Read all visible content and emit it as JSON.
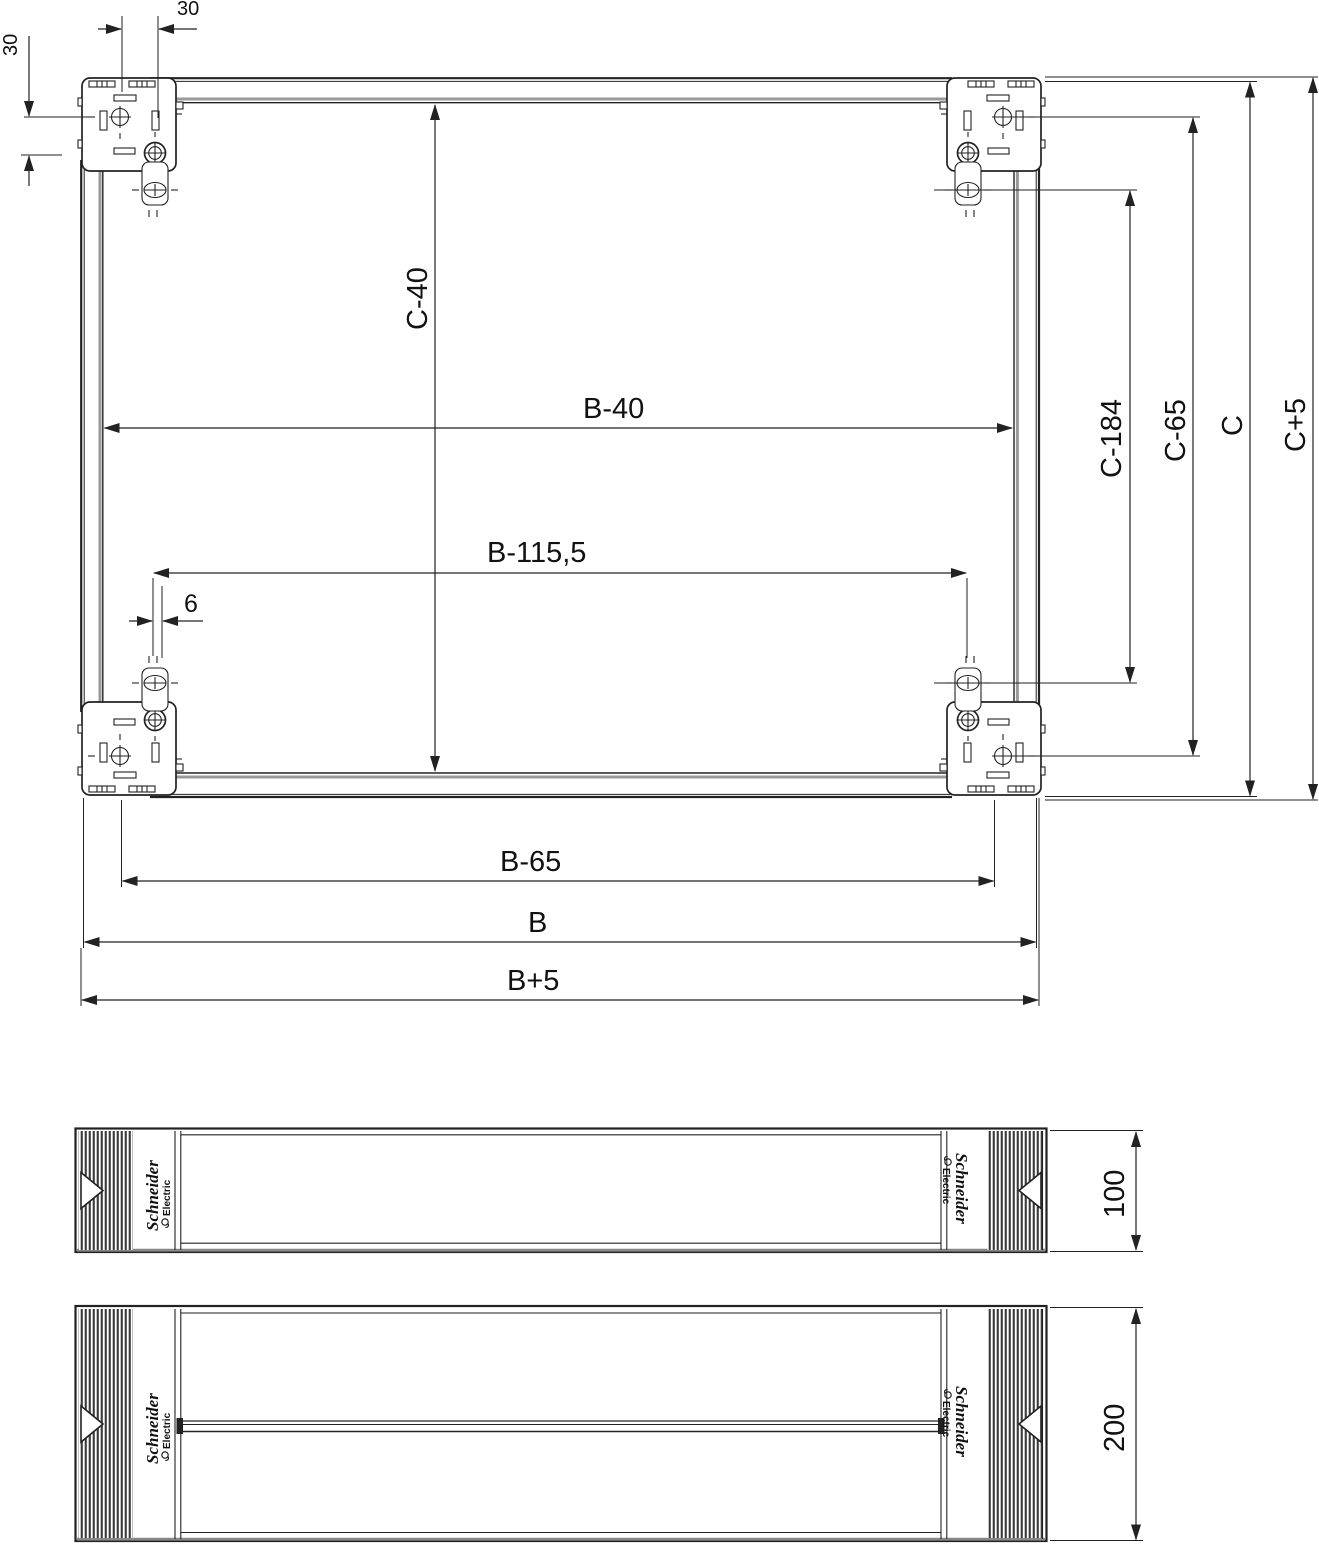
{
  "plan": {
    "dim_top_offset": "30",
    "dim_left_offset": "30",
    "dim_inner_height": "C-40",
    "dim_inner_width": "B-40",
    "dim_screw_spacing_h": "B-115,5",
    "dim_screw_offset": "6",
    "dim_bracket_spacing": "B-65",
    "dim_width": "B",
    "dim_width_overall": "B+5",
    "dim_tab_spacing_v": "C-184",
    "dim_screw_spacing_v": "C-65",
    "dim_height": "C",
    "dim_height_overall": "C+5"
  },
  "panels": {
    "small_height": "100",
    "large_height": "200",
    "brand_name": "Schneider",
    "brand_sub": "Electric"
  },
  "colors": {
    "line": "#222222",
    "shade": "#999999"
  }
}
